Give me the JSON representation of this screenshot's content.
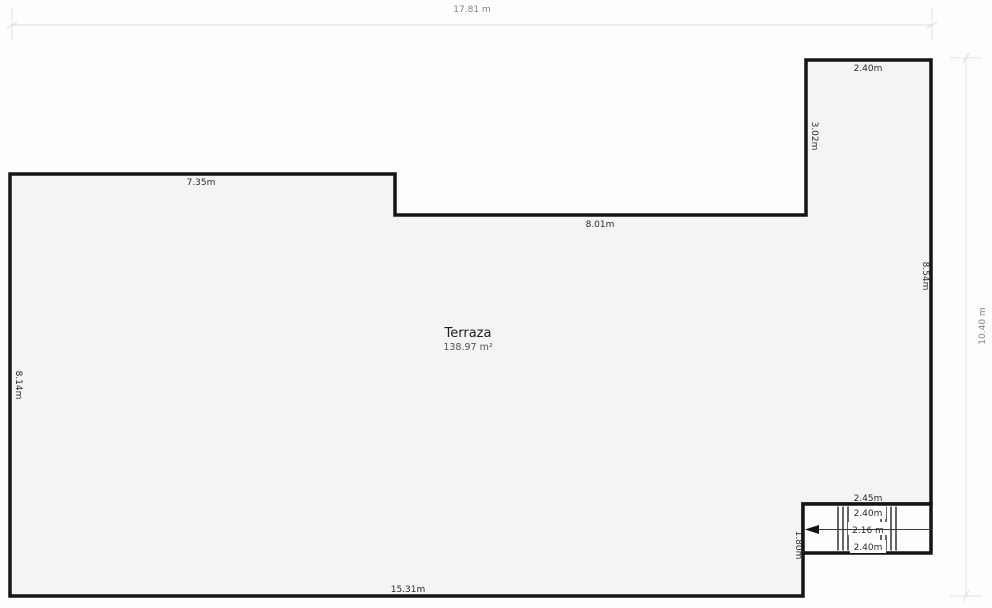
{
  "floorplan": {
    "room": {
      "name": "Terraza",
      "area": "138.97 m²"
    },
    "overall": {
      "width_label": "17.81 m",
      "height_label": "10.40 m"
    },
    "walls": {
      "top_left": "7.35m",
      "middle": "8.01m",
      "annex_top": "2.40m",
      "annex_left": "3.02m",
      "right": "8.54m",
      "left": "8.14m",
      "bottom": "15.31m"
    },
    "stairs": {
      "width": "2.45m",
      "upper_run": "2.40m",
      "walk_line": "2.16 m",
      "lower_run": "2.40m",
      "height": "1.80m"
    },
    "colors": {
      "interior": "#f4f4f4",
      "wall": "#151515",
      "dimension_line": "#e2e2e2",
      "wall_label": "#2a2a2a",
      "dimension_label": "#878787",
      "stairwell_fill": "#fdfdfd"
    }
  }
}
